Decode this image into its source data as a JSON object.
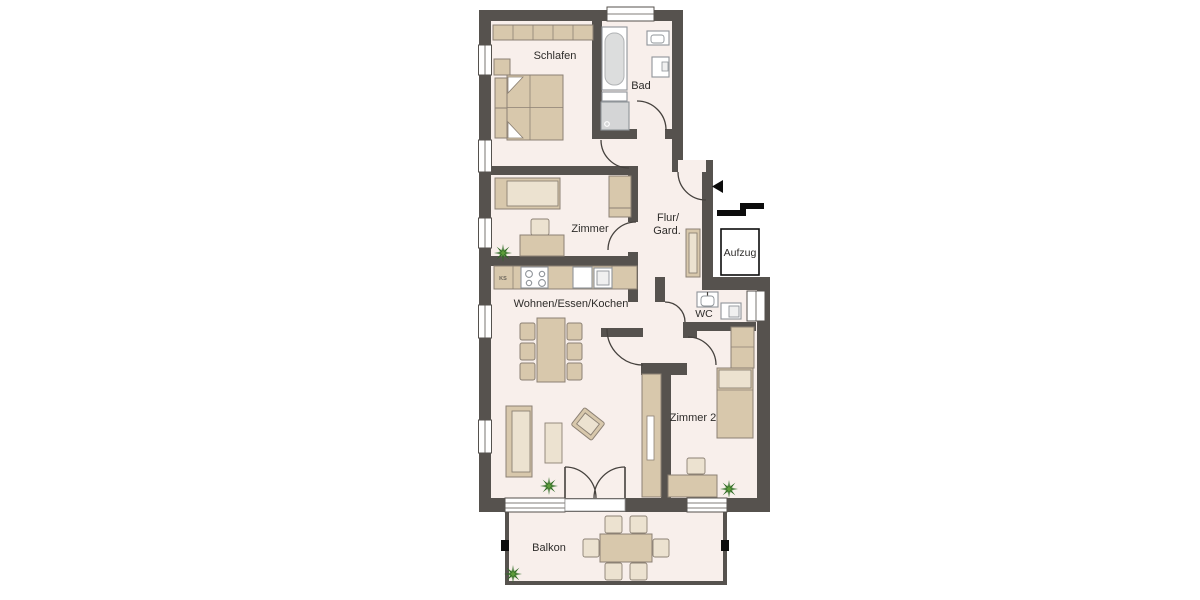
{
  "rooms": {
    "schlafen": {
      "label": "Schlafen"
    },
    "bad": {
      "label": "Bad"
    },
    "zimmer": {
      "label": "Zimmer"
    },
    "flur": {
      "label_line1": "Flur/",
      "label_line2": "Gard."
    },
    "wohnen": {
      "label": "Wohnen/Essen/Kochen"
    },
    "wc": {
      "label": "WC"
    },
    "zimmer2": {
      "label": "Zimmer 2"
    },
    "balkon": {
      "label": "Balkon"
    },
    "aufzug": {
      "label": "Aufzug"
    }
  },
  "kitchen": {
    "fridge_label": "KS"
  },
  "colors": {
    "wall": "#56524e",
    "floor": "#f8efeb",
    "furniture": "#d8c8ac",
    "furniture_light": "#ece2d0",
    "furniture_border": "#8c8174",
    "fixture_fill": "#ffffff",
    "fixture_border": "#8f9499",
    "shower": "#d4d5d6",
    "tub": "#dcdddd",
    "line": "#45413d",
    "black": "#0c0c0c",
    "label": "#2e2c2a",
    "plant_dark": "#2f6b24",
    "plant_light": "#5d9c3a"
  }
}
